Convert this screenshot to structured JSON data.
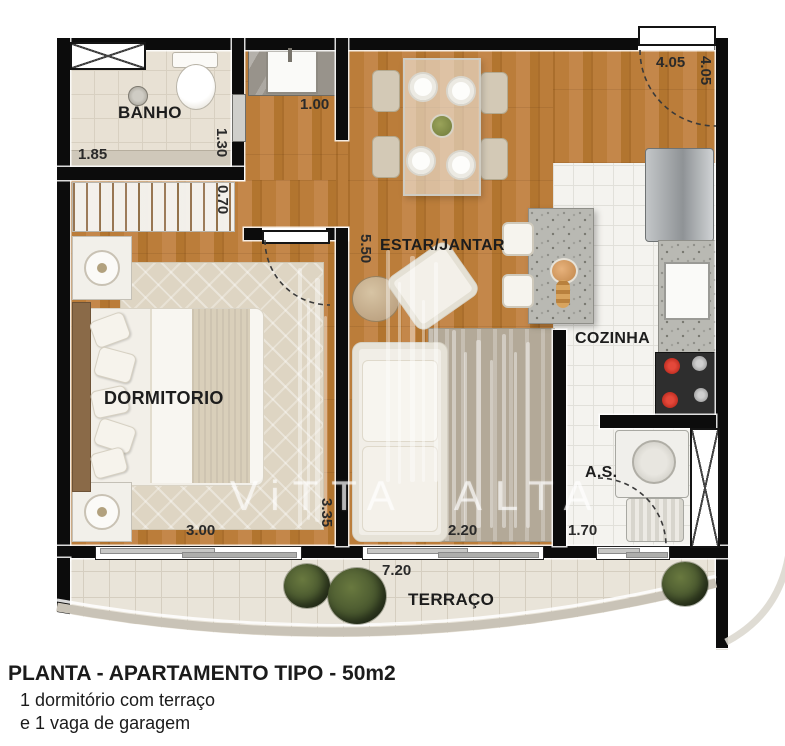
{
  "title_block": {
    "line1": "PLANTA - APARTAMENTO TIPO - 50m2",
    "line2": "1 dormitório com terraço",
    "line3": "e 1 vaga de garagem"
  },
  "watermark": "ViTTA ALTA",
  "rooms": {
    "banho": {
      "label": "BANHO",
      "width": "1.85",
      "height": "1.30"
    },
    "closet": {
      "depth": "0.70"
    },
    "hall": {
      "width": "1.00"
    },
    "dormitorio": {
      "label": "DORMITORIO",
      "width": "3.00",
      "height": "3.35"
    },
    "estar_jantar": {
      "label": "ESTAR/JANTAR",
      "width": "2.20",
      "height": "5.50"
    },
    "entrada": {
      "width": "4.05",
      "height": "4.05"
    },
    "cozinha": {
      "label": "COZINHA"
    },
    "area_servico": {
      "label": "A.S.",
      "width": "1.70"
    },
    "terraco": {
      "label": "TERRAÇO",
      "width": "7.20"
    }
  },
  "colors": {
    "wall": "#0c0c0c",
    "wood_floor": "#b87c3a",
    "banho_tile": "#e8e1d4",
    "kitchen_tile": "#f4f3ef",
    "terrace_tile": "#e9e4d9",
    "granite": "#b9b9b3",
    "stove_burner_red": "#cd2a1e",
    "label_text": "#1d1d1d"
  }
}
